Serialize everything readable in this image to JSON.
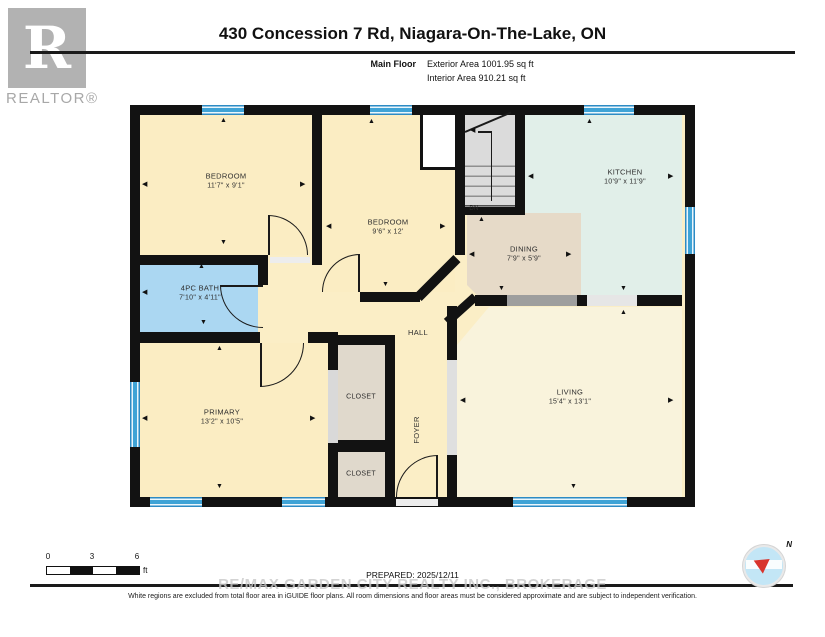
{
  "header": {
    "logo_text": "R",
    "logo_caption": "REALTOR®",
    "title": "430 Concession 7 Rd, Niagara-On-The-Lake, ON",
    "floor_label": "Main Floor",
    "exterior_area": "Exterior Area 1001.95 sq ft",
    "interior_area": "Interior Area 910.21 sq ft"
  },
  "plan": {
    "rooms": {
      "bedroom1": {
        "name": "BEDROOM",
        "dims": "11'7\" x 9'1\""
      },
      "bedroom2": {
        "name": "BEDROOM",
        "dims": "9'6\" x 12'"
      },
      "bath": {
        "name": "4PC BATH",
        "dims": "7'10\" x 4'11\""
      },
      "primary": {
        "name": "PRIMARY",
        "dims": "13'2\" x 10'5\""
      },
      "kitchen": {
        "name": "KITCHEN",
        "dims": "10'9\" x 11'9\""
      },
      "dining": {
        "name": "DINING",
        "dims": "7'9\" x 5'9\""
      },
      "living": {
        "name": "LIVING",
        "dims": "15'4\" x 13'1\""
      },
      "closet1": {
        "name": "CLOSET"
      },
      "closet2": {
        "name": "CLOSET"
      },
      "hall": {
        "name": "HALL"
      },
      "foyer": {
        "name": "FOYER"
      }
    },
    "stairs_label": "DN"
  },
  "footer": {
    "scale": {
      "t0": "0",
      "t3": "3",
      "t6": "6",
      "unit": "ft"
    },
    "prepared": "PREPARED: 2025/12/11",
    "compass_label": "N",
    "watermark": "RE/MAX GARDEN CITY REALTY INC., BROKERAGE",
    "disclaimer": "White regions are excluded from total floor area in iGUIDE floor plans. All room dimensions and floor areas must be considered approximate and are subject to independent verification."
  },
  "colors": {
    "hall": "#FBEEC6",
    "bedroom": "#FBEDC3",
    "bath": "#ABD7F2",
    "kitchen": "#E1EFE9",
    "dining": "#E6DAC8",
    "living": "#F9F3DC",
    "closet": "#E0D9CC",
    "stairs": "#DBDBDB",
    "wall": "#121212",
    "window": "#3FA3D6"
  }
}
